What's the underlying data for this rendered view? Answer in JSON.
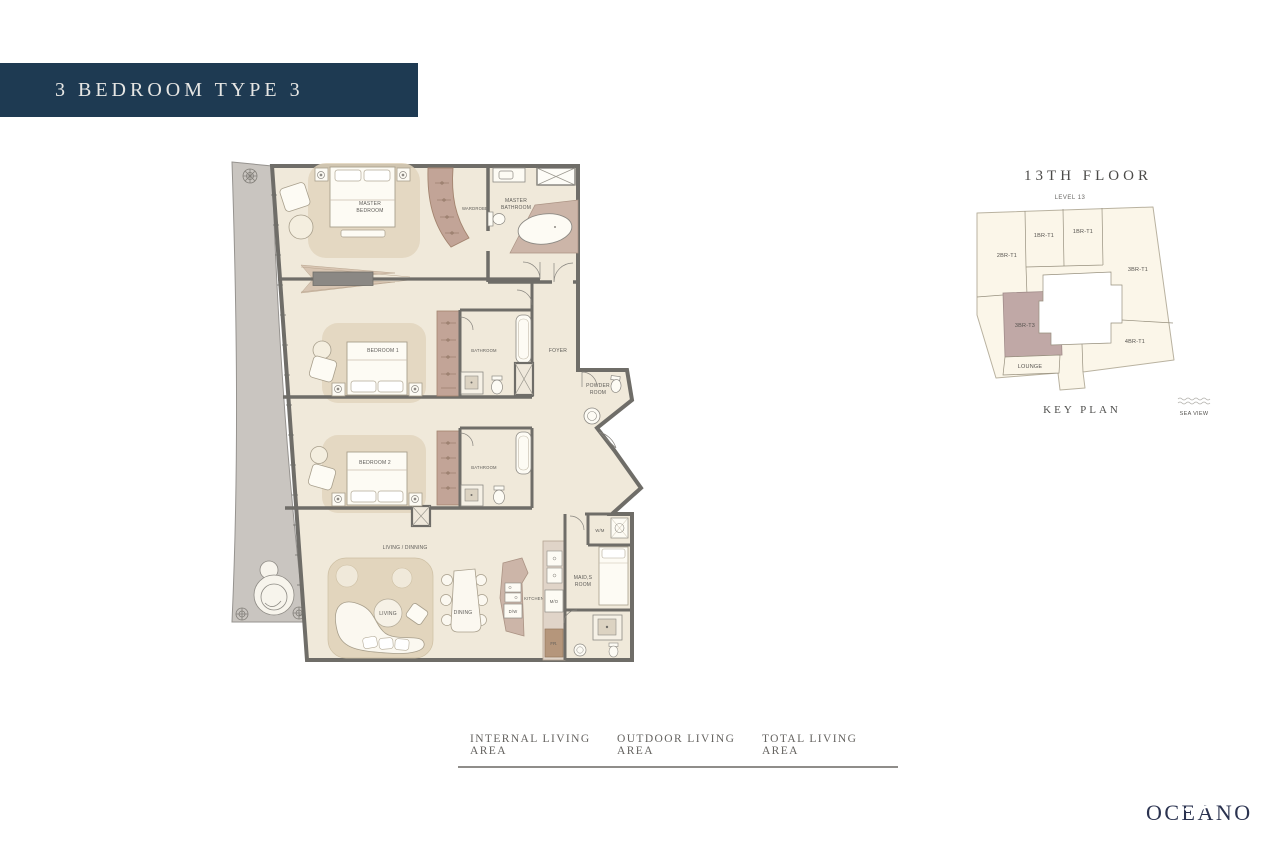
{
  "title_bar": {
    "label": "3 BEDROOM TYPE 3"
  },
  "plan": {
    "labels": {
      "master_bedroom_1": "MASTER",
      "master_bedroom_2": "BEDROOM",
      "wardrobe": "WARDROBE",
      "master_bathroom_1": "MASTER",
      "master_bathroom_2": "BATHROOM",
      "bedroom1": "BEDROOM 1",
      "bathroom1": "BATHROOM",
      "foyer": "FOYER",
      "powder_room_1": "POWDER",
      "powder_room_2": "ROOM",
      "bedroom2": "BEDROOM 2",
      "bathroom2": "BATHROOM",
      "living_dining": "LIVING / DINNING",
      "living": "LIVING",
      "dining": "DINING",
      "kitchen": "KITCHEN",
      "dishwasher": "D/W",
      "microwave": "M/O",
      "fridge": "FR.",
      "maids_room_1": "MAID,S",
      "maids_room_2": "ROOM",
      "washer": "W/M"
    }
  },
  "key_plan": {
    "title": "13TH FLOOR",
    "level": "LEVEL 13",
    "units": [
      {
        "label": "2BR-T1",
        "highlighted": false
      },
      {
        "label": "1BR-T1",
        "highlighted": false
      },
      {
        "label": "1BR-T1",
        "highlighted": false
      },
      {
        "label": "3BR-T1",
        "highlighted": false
      },
      {
        "label": "3BR-T3",
        "highlighted": true
      },
      {
        "label": "LOUNGE",
        "highlighted": false
      },
      {
        "label": "4BR-T1",
        "highlighted": false
      }
    ],
    "caption": "KEY PLAN",
    "sea_view": "SEA VIEW"
  },
  "footer": {
    "columns": [
      "INTERNAL LIVING AREA",
      "OUTDOOR LIVING AREA",
      "TOTAL LIVING AREA"
    ]
  },
  "brand": {
    "logo": "OCEANO"
  },
  "colors": {
    "title_bar_bg": "#1e3a52",
    "title_text": "#e6e6e4",
    "wall": "#6f6d68",
    "floor": "#f0e9da",
    "accent_tan": "#e2d5bd",
    "accent_mauve": "#c2a497",
    "balcony": "#c9c5c0",
    "keyplan_cream": "#fbf6e9",
    "highlight_unit": "#c0a8a6"
  }
}
